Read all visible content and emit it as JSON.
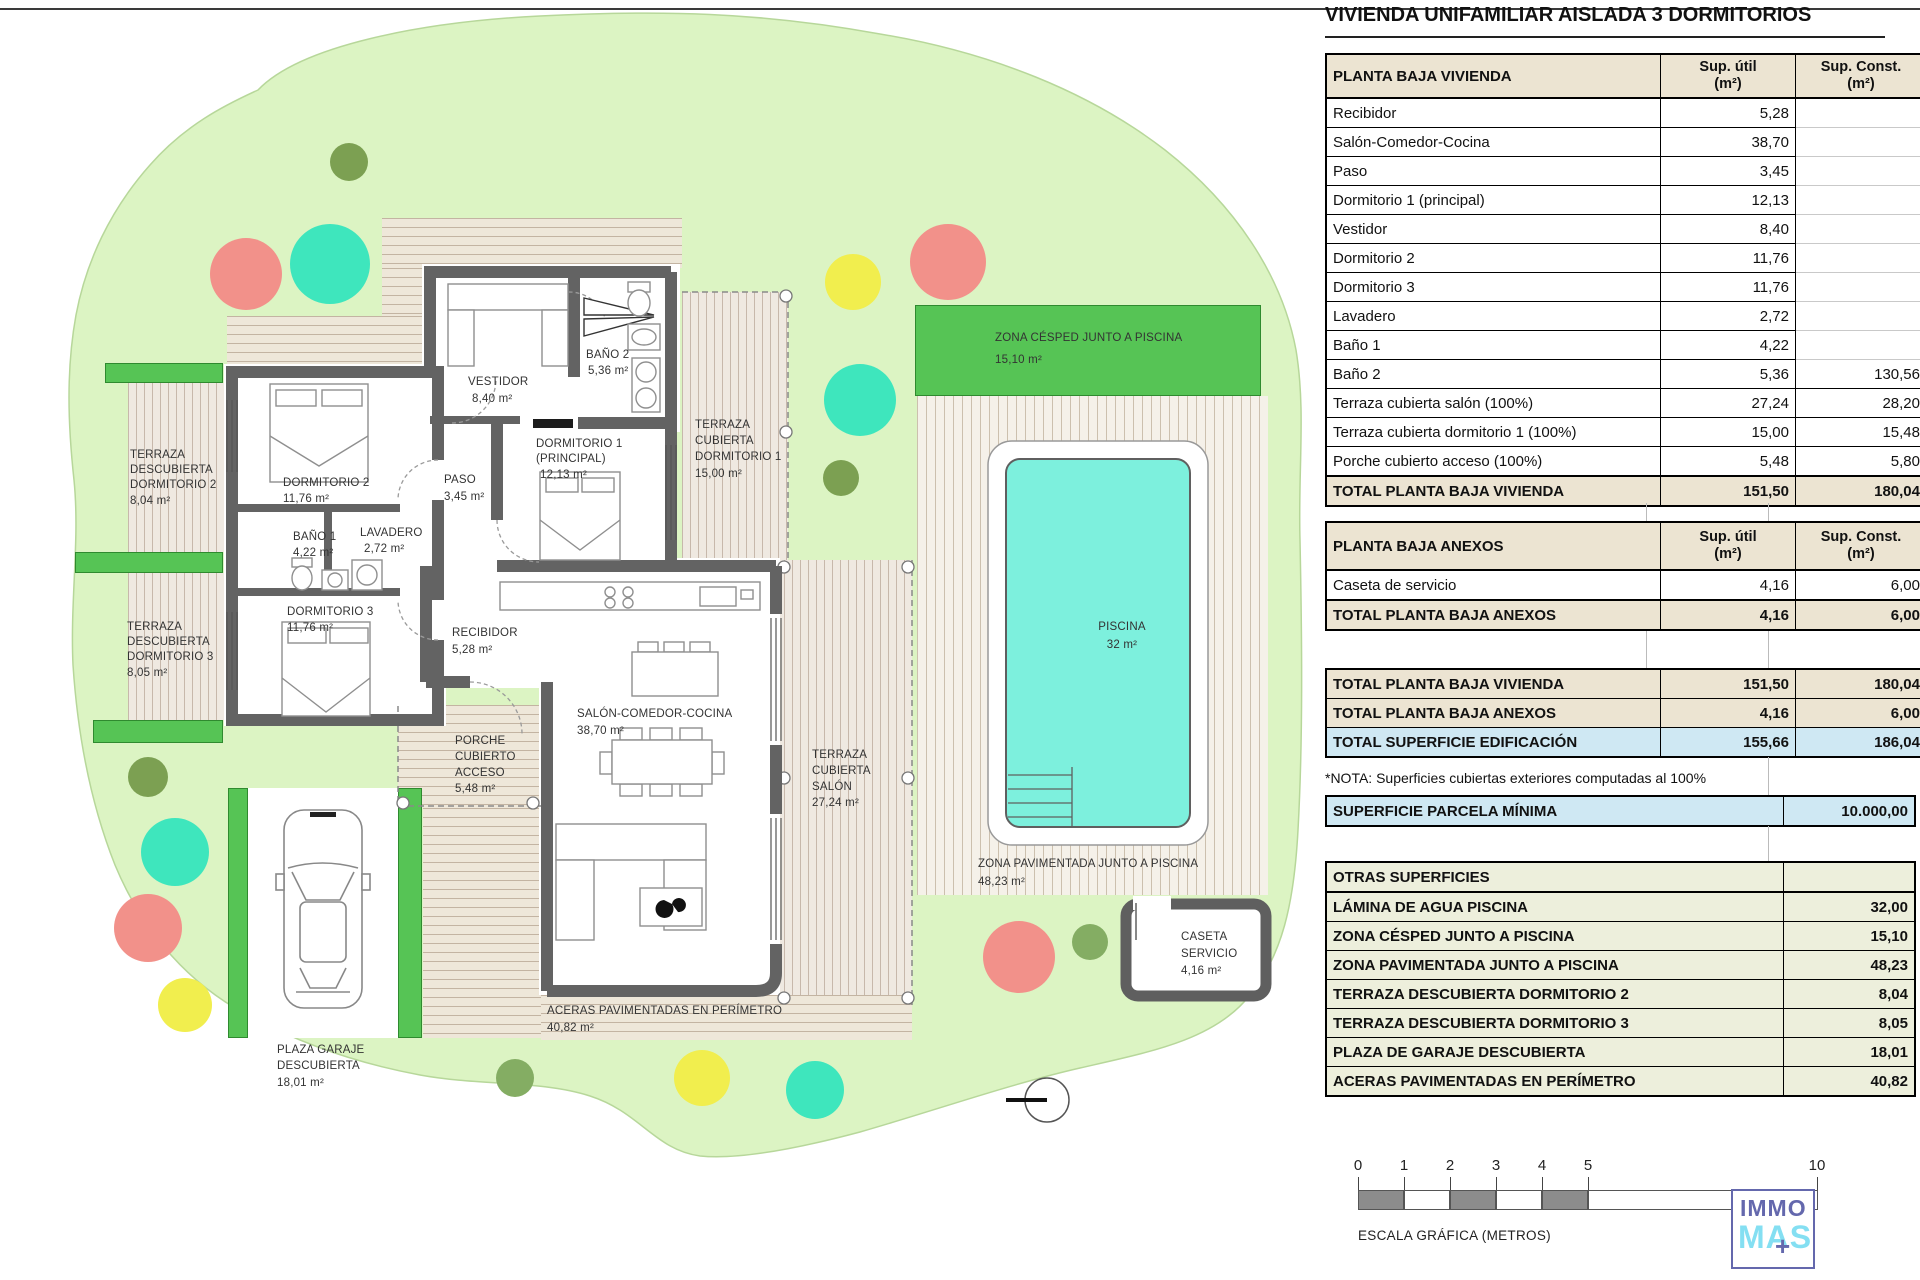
{
  "title": "VIVIENDA UNIFAMILIAR AISLADA 3 DORMITORIOS",
  "tables": {
    "headers": {
      "util_line1": "Sup. útil",
      "util_line2": "(m²)",
      "const_line1": "Sup. Const.",
      "const_line2": "(m²)"
    },
    "vivienda": {
      "header": "PLANTA BAJA VIVIENDA",
      "rows": [
        {
          "label": "Recibidor",
          "util": "5,28",
          "const": ""
        },
        {
          "label": "Salón-Comedor-Cocina",
          "util": "38,70",
          "const": ""
        },
        {
          "label": "Paso",
          "util": "3,45",
          "const": ""
        },
        {
          "label": "Dormitorio 1 (principal)",
          "util": "12,13",
          "const": ""
        },
        {
          "label": "Vestidor",
          "util": "8,40",
          "const": ""
        },
        {
          "label": "Dormitorio 2",
          "util": "11,76",
          "const": ""
        },
        {
          "label": "Dormitorio 3",
          "util": "11,76",
          "const": ""
        },
        {
          "label": "Lavadero",
          "util": "2,72",
          "const": ""
        },
        {
          "label": "Baño 1",
          "util": "4,22",
          "const": ""
        },
        {
          "label": "Baño 2",
          "util": "5,36",
          "const": "130,56"
        },
        {
          "label": "Terraza cubierta salón (100%)",
          "util": "27,24",
          "const": "28,20"
        },
        {
          "label": "Terraza cubierta dormitorio 1 (100%)",
          "util": "15,00",
          "const": "15,48"
        },
        {
          "label": "Porche cubierto acceso (100%)",
          "util": "5,48",
          "const": "5,80"
        }
      ],
      "total": {
        "label": "TOTAL PLANTA BAJA VIVIENDA",
        "util": "151,50",
        "const": "180,04"
      }
    },
    "anexos": {
      "header": "PLANTA BAJA ANEXOS",
      "rows": [
        {
          "label": "Caseta de servicio",
          "util": "4,16",
          "const": "6,00"
        }
      ],
      "total": {
        "label": "TOTAL PLANTA BAJA ANEXOS",
        "util": "4,16",
        "const": "6,00"
      }
    },
    "resumen": {
      "rows": [
        {
          "label": "TOTAL PLANTA BAJA VIVIENDA",
          "util": "151,50",
          "const": "180,04"
        },
        {
          "label": "TOTAL PLANTA BAJA ANEXOS",
          "util": "4,16",
          "const": "6,00"
        },
        {
          "label": "TOTAL SUPERFICIE EDIFICACIÓN",
          "util": "155,66",
          "const": "186,04"
        }
      ]
    },
    "nota": "*NOTA: Superficies cubiertas exteriores computadas al 100%",
    "parcela": {
      "label": "SUPERFICIE PARCELA MÍNIMA",
      "value": "10.000,00"
    },
    "otras": {
      "header": "OTRAS SUPERFICIES",
      "rows": [
        {
          "label": "LÁMINA DE AGUA PISCINA",
          "value": "32,00"
        },
        {
          "label": "ZONA CÉSPED JUNTO A PISCINA",
          "value": "15,10"
        },
        {
          "label": "ZONA PAVIMENTADA JUNTO A PISCINA",
          "value": "48,23"
        },
        {
          "label": "TERRAZA DESCUBIERTA DORMITORIO 2",
          "value": "8,04"
        },
        {
          "label": "TERRAZA DESCUBIERTA DORMITORIO 3",
          "value": "8,05"
        },
        {
          "label": "PLAZA DE GARAJE DESCUBIERTA",
          "value": "18,01"
        },
        {
          "label": "ACERAS PAVIMENTADAS EN PERÍMETRO",
          "value": "40,82"
        }
      ]
    }
  },
  "plan": {
    "labels": {
      "td2": {
        "lines": [
          "TERRAZA",
          "DESCUBIERTA",
          "DORMITORIO 2",
          "8,04 m²"
        ]
      },
      "td3": {
        "lines": [
          "TERRAZA",
          "DESCUBIERTA",
          "DORMITORIO 3",
          "8,05 m²"
        ]
      },
      "dorm2": {
        "lines": [
          "DORMITORIO 2",
          "11,76 m²"
        ]
      },
      "bano1": {
        "lines": [
          "BAÑO 1",
          "4,22 m²"
        ]
      },
      "lavadero": {
        "lines": [
          "LAVADERO",
          "2,72 m²"
        ]
      },
      "dorm3": {
        "lines": [
          "DORMITORIO 3",
          "11,76 m²"
        ]
      },
      "paso": {
        "lines": [
          "PASO",
          "3,45 m²"
        ]
      },
      "vestidor": {
        "lines": [
          "VESTIDOR",
          "8,40 m²"
        ]
      },
      "bano2": {
        "lines": [
          "BAÑO 2",
          "5,36 m²"
        ]
      },
      "dorm1": {
        "lines": [
          "DORMITORIO 1",
          "(PRINCIPAL)",
          "12,13 m²"
        ]
      },
      "tcd1": {
        "lines": [
          "TERRAZA",
          "CUBIERTA",
          "DORMITORIO 1",
          "15,00 m²"
        ]
      },
      "recibidor": {
        "lines": [
          "RECIBIDOR",
          "5,28 m²"
        ]
      },
      "salon": {
        "lines": [
          "SALÓN-COMEDOR-COCINA",
          "38,70 m²"
        ]
      },
      "porche": {
        "lines": [
          "PORCHE",
          "CUBIERTO",
          "ACCESO",
          "5,48 m²"
        ]
      },
      "tcs": {
        "lines": [
          "TERRAZA",
          "CUBIERTA",
          "SALÓN",
          "27,24 m²"
        ]
      },
      "cesped": {
        "lines": [
          "ZONA CÉSPED JUNTO A PISCINA",
          "15,10 m²"
        ]
      },
      "piscina": {
        "lines": [
          "PISCINA",
          "32 m²"
        ]
      },
      "pavimentada": {
        "lines": [
          "ZONA PAVIMENTADA JUNTO A PISCINA",
          "48,23 m²"
        ]
      },
      "caseta": {
        "lines": [
          "CASETA",
          "SERVICIO",
          "4,16 m²"
        ]
      },
      "aceras": {
        "lines": [
          "ACERAS PAVIMENTADAS EN PERÍMETRO",
          "40,82 m²"
        ]
      },
      "plaza": {
        "lines": [
          "PLAZA GARAJE",
          "DESCUBIERTA",
          "18,01 m²"
        ]
      }
    },
    "colors": {
      "lawn": "#dcf4c3",
      "wall": "#636363",
      "pool": "#7df0dd",
      "hedge_green": "#56c455",
      "tree_teal": "#3ee6bd",
      "tree_red": "#f2918a",
      "tree_yellow": "#f1ee4e",
      "tree_olive": "#7ca052",
      "tree_green": "#84ad63"
    }
  },
  "scalebar": {
    "ticks": [
      "0",
      "1",
      "2",
      "3",
      "4",
      "5",
      "10"
    ],
    "caption": "ESCALA GRÁFICA (METROS)"
  },
  "logo": {
    "line1": "IMMO",
    "line2": "MAS",
    "plus": "+"
  }
}
